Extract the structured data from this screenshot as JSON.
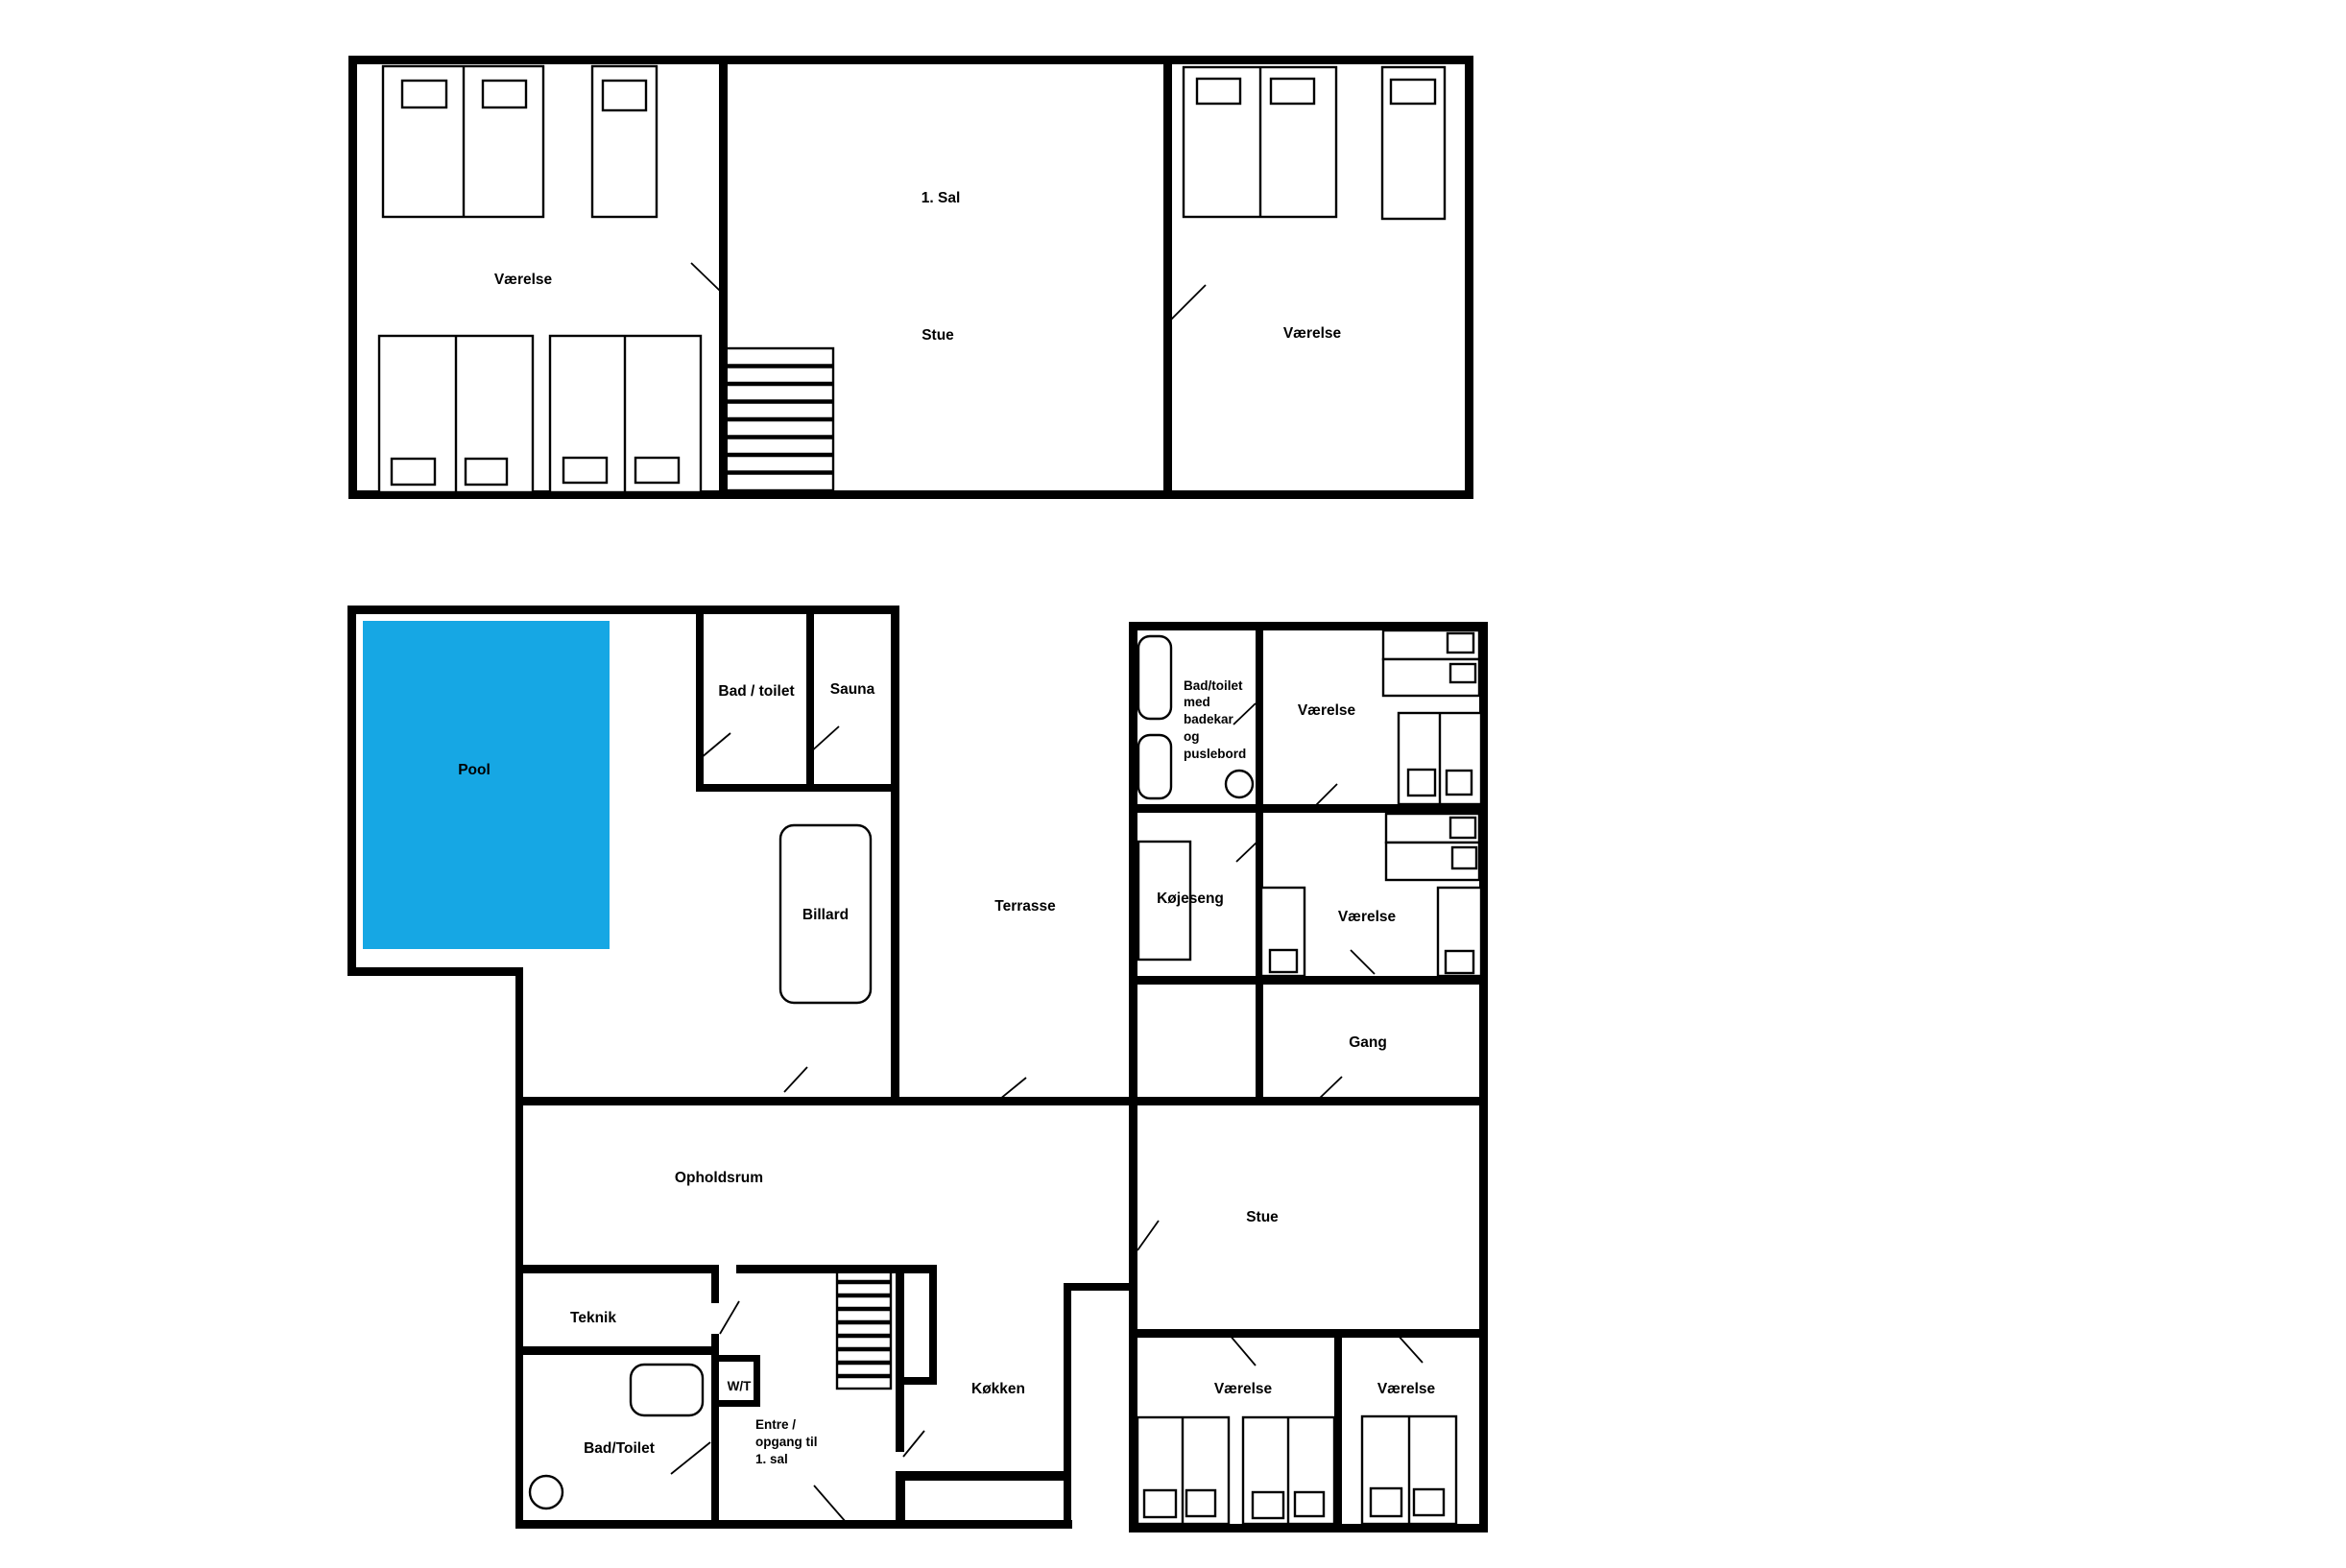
{
  "colors": {
    "pool_fill": "#16A7E4",
    "pool_label": "#1B3950",
    "wall": "#000000",
    "text": "#000000"
  },
  "first_floor": {
    "floor_label": "1. Sal",
    "bedroom_left": "Værelse",
    "living_room": "Stue",
    "bedroom_right": "Værelse"
  },
  "ground_floor": {
    "pool": "Pool",
    "bath_toilet": "Bad / toilet",
    "sauna": "Sauna",
    "billiards": "Billard",
    "terrace": "Terrasse",
    "family_bath_lines": [
      "Bad/toilet",
      "med",
      "badekar",
      "og",
      "puslebord"
    ],
    "bedroom_ne": "Værelse",
    "bunk_room": "Køjeseng",
    "bedroom_e": "Værelse",
    "hallway": "Gang",
    "lounge": "Opholdsrum",
    "living_room": "Stue",
    "tech_room": "Teknik",
    "wt": "W/T",
    "bath_toilet_2": "Bad/Toilet",
    "entry_lines": [
      "Entre /",
      "opgang til",
      "1. sal"
    ],
    "kitchen": "Køkken",
    "bedroom_s1": "Værelse",
    "bedroom_s2": "Værelse"
  }
}
